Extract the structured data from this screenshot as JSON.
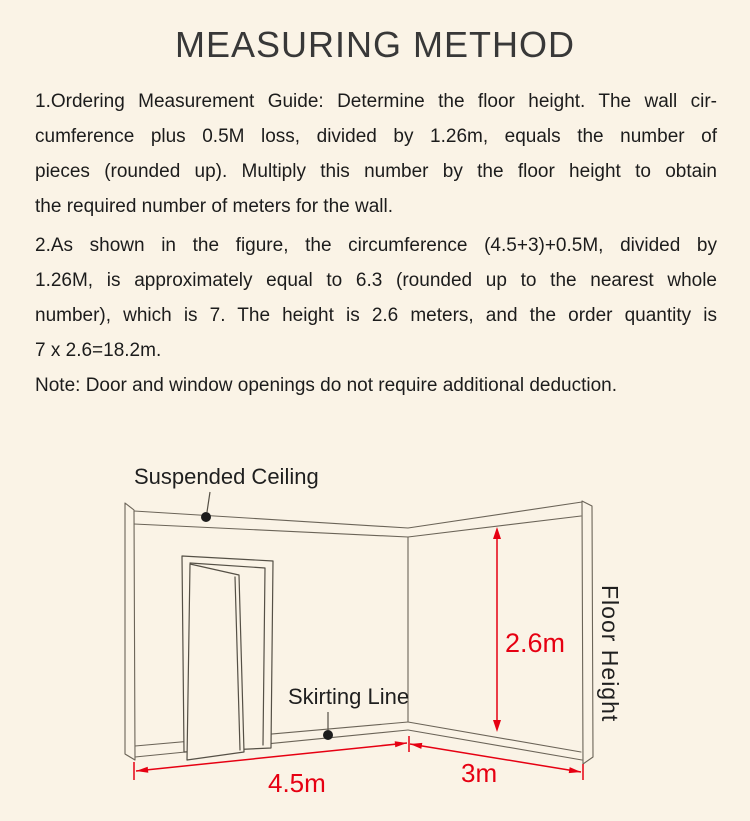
{
  "colors": {
    "background": "#faf3e6",
    "body_text": "#1c1c1c",
    "title_text": "#383838",
    "accent_red": "#e60012",
    "line_art": "#6b6458",
    "callout_dot": "#1c1c1c"
  },
  "header": {
    "title": "MEASURING METHOD"
  },
  "instructions": {
    "lines": [
      "1.Ordering Measurement Guide: Determine the floor height. The wall cir-",
      "cumference plus 0.5M loss, divided by 1.26m, equals the number of",
      "pieces (rounded up). Multiply this number by the floor height to obtain",
      "the required number of meters for the wall.",
      "2.As shown in the figure, the circumference (4.5+3)+0.5M, divided by",
      "1.26M, is approximately equal to 6.3 (rounded up to the nearest whole",
      "number), which is 7. The height is 2.6 meters, and the order quantity is",
      "7 x 2.6=18.2m.",
      "Note: Door and window openings do not require additional deduction."
    ]
  },
  "diagram": {
    "labels": {
      "suspended_ceiling": "Suspended Ceiling",
      "skirting_line": "Skirting Line",
      "floor_height": "Floor Height"
    },
    "dimensions": {
      "wall_height": "2.6m",
      "left_wall_length": "4.5m",
      "right_wall_length": "3m"
    }
  }
}
